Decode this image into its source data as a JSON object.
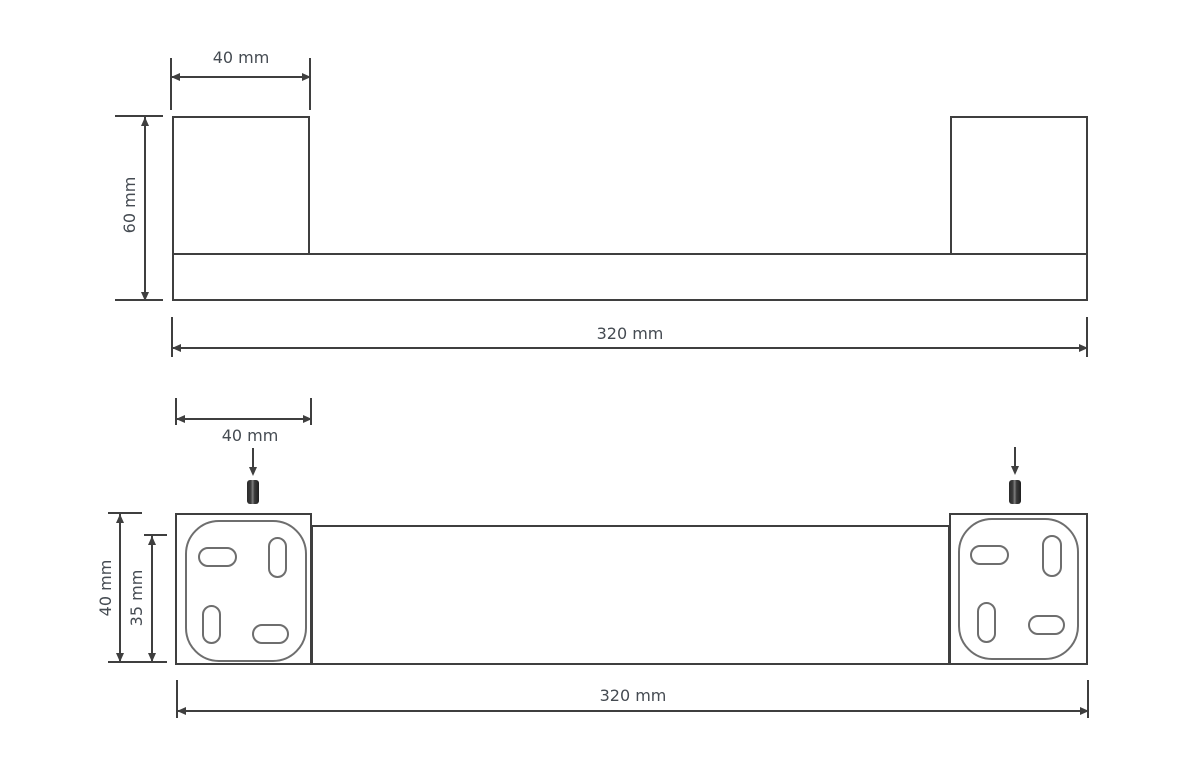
{
  "drawing": {
    "title": "towel-bar-dimension-drawing",
    "front_view": {
      "bracket_width_label": "40 mm",
      "total_height_label": "60 mm",
      "total_width_label": "320 mm"
    },
    "plan_view": {
      "bracket_width_label": "40 mm",
      "bracket_depth_label": "40 mm",
      "plate_depth_label": "35 mm",
      "total_width_label": "320 mm"
    },
    "colors": {
      "outline": "#3f3f3f",
      "thin_outline": "#6e6e6e",
      "label_text": "#454b52",
      "screw_fill": "#3a3a3a",
      "background": "#ffffff"
    }
  }
}
